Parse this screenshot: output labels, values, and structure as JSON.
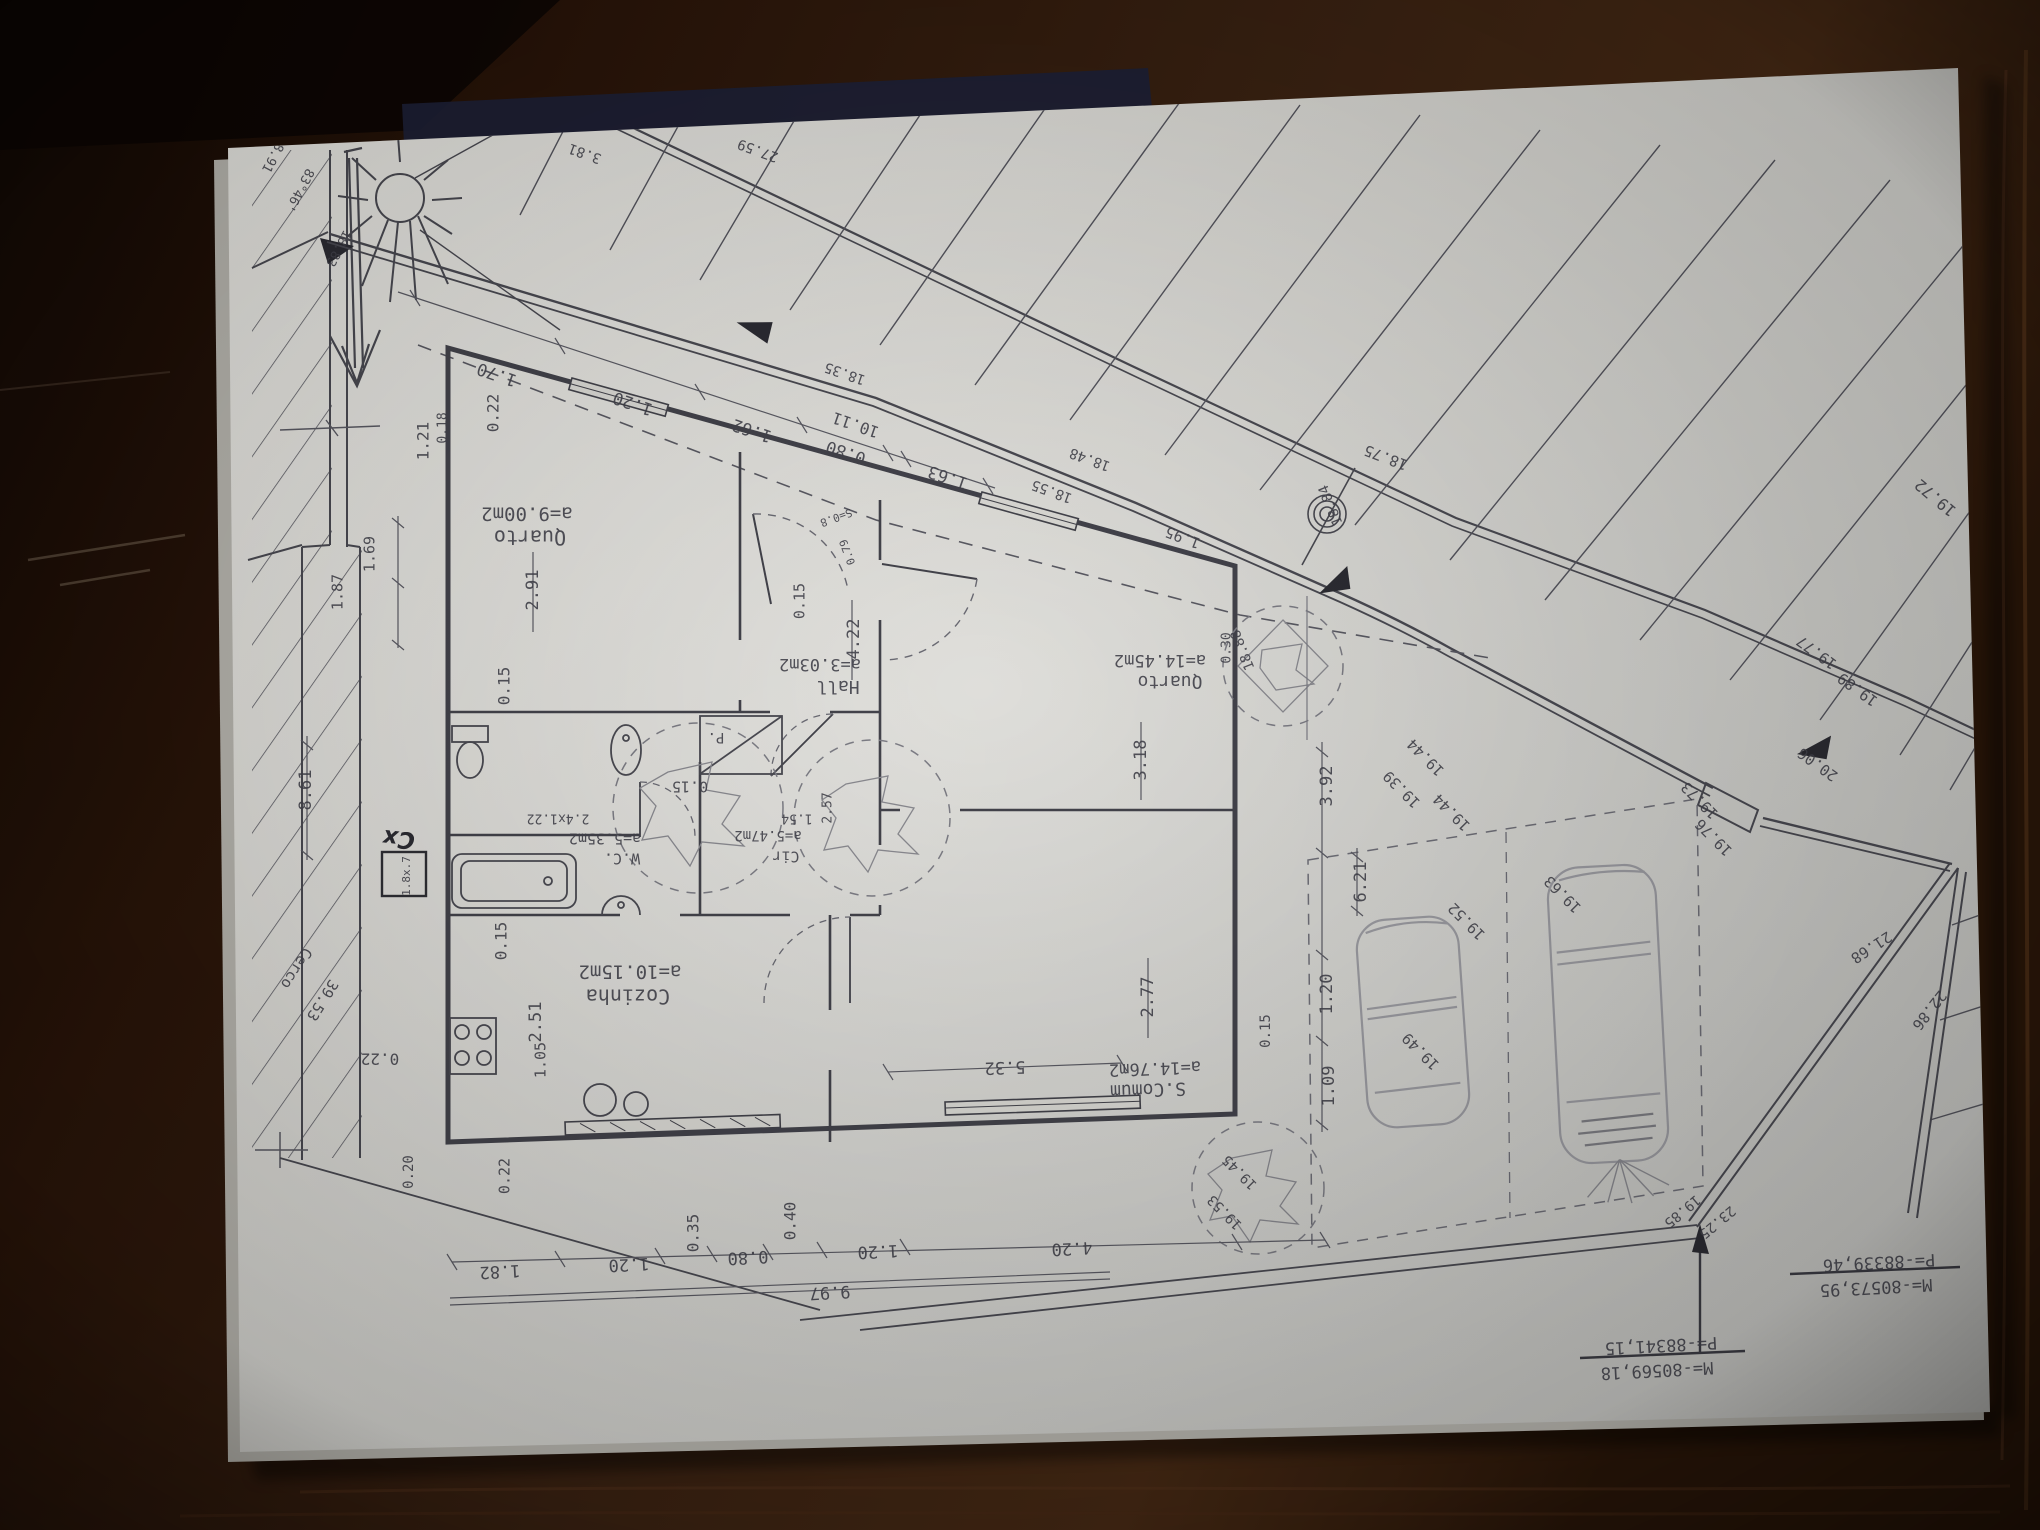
{
  "photo": {
    "colors": {
      "wood_dark": "#1d110a",
      "wood_mid": "#35200f",
      "wood_light": "#4a2b17",
      "paper": "#d9d8d3",
      "ink": "#46464f",
      "pencil": "#9c9ca2",
      "navy_strip": "#1e2238"
    }
  },
  "plan": {
    "rooms": [
      {
        "name": "Quarto",
        "area": "a=9.00m2"
      },
      {
        "name": "Hall",
        "area": "a=3.03m2"
      },
      {
        "name": "Quarto",
        "area": "a=14.45m2"
      },
      {
        "name": "W.C.",
        "area": "a=5.35m2"
      },
      {
        "name": "Cir",
        "area": "a=5.47m2"
      },
      {
        "name": "Cozinha",
        "area": "a=10.15m2"
      },
      {
        "name": "S.Comum",
        "area": "a=14.76m2"
      }
    ],
    "coordinate_markers": [
      {
        "p": "P=-88339,46",
        "m": "M=-80573,95"
      },
      {
        "p": "P=-88341,15",
        "m": "M=-80569,18"
      }
    ],
    "labels": [
      {
        "t": "a=9.00m2",
        "x": 527,
        "y": 513,
        "r": 0,
        "s": 19,
        "n": "room-area-label"
      },
      {
        "t": "Quarto",
        "x": 530,
        "y": 536,
        "r": 0,
        "s": 20,
        "n": "room-name-label"
      },
      {
        "t": "a=3.03m2",
        "x": 820,
        "y": 664,
        "r": 0,
        "s": 17,
        "n": "room-area-label"
      },
      {
        "t": "Hall",
        "x": 838,
        "y": 686,
        "r": 0,
        "s": 18,
        "n": "room-name-label"
      },
      {
        "t": "a=14.45m2",
        "x": 1160,
        "y": 660,
        "r": 0,
        "s": 17,
        "n": "room-area-label"
      },
      {
        "t": "Quarto",
        "x": 1170,
        "y": 681,
        "r": 0,
        "s": 18,
        "n": "room-name-label"
      },
      {
        "t": "a=14.76m2",
        "x": 1155,
        "y": 1068,
        "r": -2,
        "s": 17,
        "n": "room-area-label"
      },
      {
        "t": "S.Comum",
        "x": 1148,
        "y": 1089,
        "r": -2,
        "s": 18,
        "n": "room-name-label"
      },
      {
        "t": "a=10.15m2",
        "x": 630,
        "y": 971,
        "r": 0,
        "s": 19,
        "n": "room-area-label"
      },
      {
        "t": "Cozinha",
        "x": 628,
        "y": 995,
        "r": 0,
        "s": 20,
        "n": "room-name-label"
      },
      {
        "t": "a=5.35m2",
        "x": 605,
        "y": 838,
        "r": 0,
        "s": 15,
        "n": "room-area-label"
      },
      {
        "t": "W.C.",
        "x": 622,
        "y": 858,
        "r": 0,
        "s": 15,
        "n": "room-name-label"
      },
      {
        "t": "a=5.47m2",
        "x": 768,
        "y": 835,
        "r": 0,
        "s": 14,
        "n": "room-area-label"
      },
      {
        "t": "Cir",
        "x": 786,
        "y": 856,
        "r": 0,
        "s": 15,
        "n": "room-name-label"
      },
      {
        "t": "P.",
        "x": 716,
        "y": 737,
        "r": 0,
        "s": 14
      },
      {
        "t": "2.4x1.22",
        "x": 558,
        "y": 818,
        "r": 0,
        "s": 13
      },
      {
        "t": "1.54",
        "x": 797,
        "y": 818,
        "r": 0,
        "s": 13
      },
      {
        "t": "2.57",
        "x": 828,
        "y": 808,
        "r": 90,
        "s": 13
      },
      {
        "t": "1.70",
        "x": 497,
        "y": 374,
        "r": 19,
        "s": 17
      },
      {
        "t": "1.20",
        "x": 633,
        "y": 403,
        "r": 19,
        "s": 17
      },
      {
        "t": "1.62",
        "x": 752,
        "y": 430,
        "r": 19,
        "s": 17
      },
      {
        "t": "0.80",
        "x": 846,
        "y": 452,
        "r": 19,
        "s": 17
      },
      {
        "t": "10.11",
        "x": 856,
        "y": 424,
        "r": 19,
        "s": 16
      },
      {
        "t": "1.63",
        "x": 948,
        "y": 477,
        "r": 19,
        "s": 17
      },
      {
        "t": "0.22",
        "x": 494,
        "y": 413,
        "r": 90,
        "s": 16
      },
      {
        "t": "1.21",
        "x": 424,
        "y": 441,
        "r": 90,
        "s": 16
      },
      {
        "t": "0.18",
        "x": 443,
        "y": 428,
        "r": 90,
        "s": 13
      },
      {
        "t": "2.91",
        "x": 533,
        "y": 590,
        "r": 90,
        "s": 17
      },
      {
        "t": "0.15",
        "x": 505,
        "y": 686,
        "r": 90,
        "s": 16
      },
      {
        "t": "0.15",
        "x": 690,
        "y": 786,
        "r": 0,
        "s": 15
      },
      {
        "t": "0.15",
        "x": 502,
        "y": 941,
        "r": 90,
        "s": 16
      },
      {
        "t": "2.51",
        "x": 536,
        "y": 1022,
        "r": 90,
        "s": 17
      },
      {
        "t": "0.22",
        "x": 380,
        "y": 1058,
        "r": 0,
        "s": 16
      },
      {
        "t": "0.20",
        "x": 409,
        "y": 1172,
        "r": 90,
        "s": 14
      },
      {
        "t": "0.22",
        "x": 505,
        "y": 1176,
        "r": 90,
        "s": 15
      },
      {
        "t": "1.05",
        "x": 541,
        "y": 1060,
        "r": 90,
        "s": 15
      },
      {
        "t": "0.15",
        "x": 800,
        "y": 601,
        "r": 90,
        "s": 15
      },
      {
        "t": "4.22",
        "x": 854,
        "y": 639,
        "r": 90,
        "s": 17
      },
      {
        "t": "3.18",
        "x": 1141,
        "y": 760,
        "r": 90,
        "s": 17
      },
      {
        "t": "2.77",
        "x": 1148,
        "y": 997,
        "r": 90,
        "s": 17
      },
      {
        "t": "5.32",
        "x": 1005,
        "y": 1067,
        "r": -2,
        "s": 17
      },
      {
        "t": "9.97",
        "x": 830,
        "y": 1292,
        "r": -3,
        "s": 17
      },
      {
        "t": "1.82",
        "x": 500,
        "y": 1271,
        "r": -3,
        "s": 17
      },
      {
        "t": "1.20",
        "x": 629,
        "y": 1264,
        "r": -3,
        "s": 17
      },
      {
        "t": "0.35",
        "x": 694,
        "y": 1233,
        "r": 90,
        "s": 16
      },
      {
        "t": "0.80",
        "x": 748,
        "y": 1257,
        "r": -3,
        "s": 17
      },
      {
        "t": "0.40",
        "x": 791,
        "y": 1221,
        "r": 90,
        "s": 16
      },
      {
        "t": "1.20",
        "x": 878,
        "y": 1251,
        "r": -3,
        "s": 17
      },
      {
        "t": "4.20",
        "x": 1072,
        "y": 1248,
        "r": -3,
        "s": 17
      },
      {
        "t": "0.30",
        "x": 1227,
        "y": 648,
        "r": 90,
        "s": 13
      },
      {
        "t": "3.92",
        "x": 1327,
        "y": 786,
        "r": 90,
        "s": 17
      },
      {
        "t": "6.21",
        "x": 1361,
        "y": 882,
        "r": 90,
        "s": 17
      },
      {
        "t": "1.20",
        "x": 1327,
        "y": 994,
        "r": 90,
        "s": 17
      },
      {
        "t": "1.09",
        "x": 1329,
        "y": 1086,
        "r": 90,
        "s": 17
      },
      {
        "t": "0.15",
        "x": 1266,
        "y": 1031,
        "r": 90,
        "s": 14
      },
      {
        "t": "8.61",
        "x": 306,
        "y": 790,
        "r": 90,
        "s": 17
      },
      {
        "t": "1.69",
        "x": 370,
        "y": 554,
        "r": 90,
        "s": 15
      },
      {
        "t": "1.87",
        "x": 338,
        "y": 592,
        "r": 90,
        "s": 15
      },
      {
        "t": "Cerco",
        "x": 296,
        "y": 968,
        "r": -58,
        "s": 15,
        "n": "fence-label"
      },
      {
        "t": "39.53",
        "x": 322,
        "y": 1000,
        "r": -58,
        "s": 15
      },
      {
        "t": "19.44",
        "x": 1426,
        "y": 757,
        "r": 45,
        "s": 15
      },
      {
        "t": "19.44",
        "x": 1452,
        "y": 812,
        "r": 45,
        "s": 15
      },
      {
        "t": "19.39",
        "x": 1402,
        "y": 789,
        "r": 45,
        "s": 15
      },
      {
        "t": "19.52",
        "x": 1467,
        "y": 921,
        "r": 45,
        "s": 15
      },
      {
        "t": "19.49",
        "x": 1421,
        "y": 1051,
        "r": 45,
        "s": 15
      },
      {
        "t": "19.63",
        "x": 1563,
        "y": 894,
        "r": 45,
        "s": 15
      },
      {
        "t": "19.73",
        "x": 1700,
        "y": 800,
        "r": 45,
        "s": 15
      },
      {
        "t": "19.76",
        "x": 1714,
        "y": 837,
        "r": 45,
        "s": 15
      },
      {
        "t": "19.45",
        "x": 1240,
        "y": 1172,
        "r": 45,
        "s": 14
      },
      {
        "t": "19.53",
        "x": 1225,
        "y": 1212,
        "r": 45,
        "s": 14
      },
      {
        "t": "19.72",
        "x": 1936,
        "y": 497,
        "r": 40,
        "s": 16
      },
      {
        "t": "19.77",
        "x": 1817,
        "y": 652,
        "r": 36,
        "s": 15
      },
      {
        "t": "19.89",
        "x": 1858,
        "y": 689,
        "r": 36,
        "s": 15
      },
      {
        "t": "20.06",
        "x": 1818,
        "y": 764,
        "r": 36,
        "s": 15
      },
      {
        "t": "21.68",
        "x": 1871,
        "y": 947,
        "r": -33,
        "s": 15
      },
      {
        "t": "22.86",
        "x": 1929,
        "y": 1010,
        "r": -52,
        "s": 15
      },
      {
        "t": "19.85",
        "x": 1682,
        "y": 1211,
        "r": -40,
        "s": 14
      },
      {
        "t": "23.25",
        "x": 1717,
        "y": 1222,
        "r": -40,
        "s": 14
      },
      {
        "t": "18.35",
        "x": 845,
        "y": 373,
        "r": 19,
        "s": 14
      },
      {
        "t": "18.48",
        "x": 1090,
        "y": 459,
        "r": 20,
        "s": 14
      },
      {
        "t": "18.55",
        "x": 1052,
        "y": 491,
        "r": 20,
        "s": 14
      },
      {
        "t": "18.75",
        "x": 1386,
        "y": 457,
        "r": 21,
        "s": 15
      },
      {
        "t": "18.84",
        "x": 1331,
        "y": 505,
        "r": 68,
        "s": 14
      },
      {
        "t": "18.88",
        "x": 1243,
        "y": 650,
        "r": 68,
        "s": 14
      },
      {
        "t": "1.95",
        "x": 1183,
        "y": 537,
        "r": 21,
        "s": 15
      },
      {
        "t": "3.81",
        "x": 585,
        "y": 153,
        "r": 20,
        "s": 14
      },
      {
        "t": "27.59",
        "x": 758,
        "y": 150,
        "r": 20,
        "s": 14
      },
      {
        "t": "83°46'",
        "x": 299,
        "y": 190,
        "r": -62,
        "s": 13,
        "n": "bearing-label"
      },
      {
        "t": "18.83",
        "x": 338,
        "y": 248,
        "r": -62,
        "s": 13
      },
      {
        "t": "18.91",
        "x": 274,
        "y": 154,
        "r": -62,
        "s": 13
      },
      {
        "t": "S=0.8",
        "x": 836,
        "y": 517,
        "r": -20,
        "s": 11
      },
      {
        "t": "0.79",
        "x": 848,
        "y": 552,
        "r": 70,
        "s": 11
      },
      {
        "t": "1.8x.7",
        "x": 407,
        "y": 876,
        "r": 90,
        "s": 11
      },
      {
        "t": "Cx",
        "x": 399,
        "y": 838,
        "r": 6,
        "s": 23,
        "c": "hand",
        "n": "handwritten-label"
      },
      {
        "t": "P=-88339,46",
        "x": 1879,
        "y": 1262,
        "r": -3,
        "s": 17,
        "n": "coordinate-label"
      },
      {
        "t": "M=-80573,95",
        "x": 1876,
        "y": 1287,
        "r": -3,
        "s": 17,
        "n": "coordinate-label"
      },
      {
        "t": "P=-88341,15",
        "x": 1661,
        "y": 1345,
        "r": -3,
        "s": 17,
        "n": "coordinate-label"
      },
      {
        "t": "M=-80569,18",
        "x": 1657,
        "y": 1370,
        "r": -3,
        "s": 17,
        "n": "coordinate-label"
      }
    ]
  }
}
